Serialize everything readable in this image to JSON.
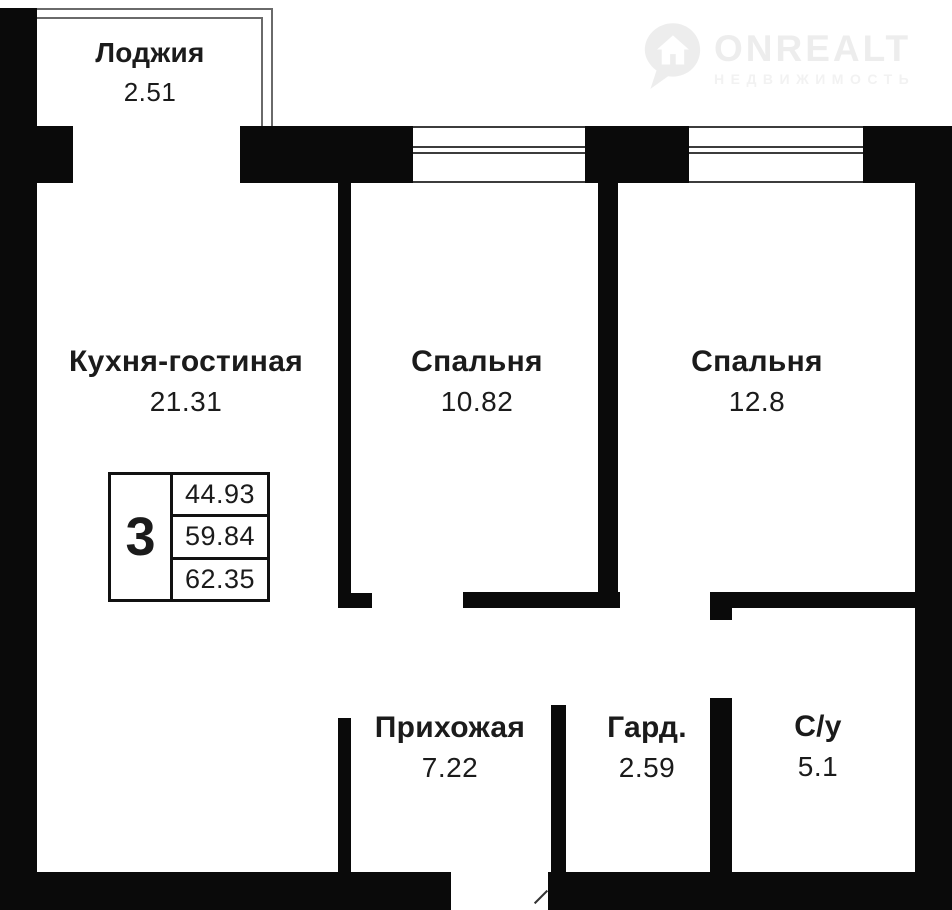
{
  "logo": {
    "brand": "ONREALT",
    "subtitle": "НЕДВИЖИМОСТЬ",
    "icon": "location-pin-with-house"
  },
  "stamp": {
    "rooms_count": "3",
    "areas": [
      "44.93",
      "59.84",
      "62.35"
    ]
  },
  "rooms": {
    "loggia": {
      "name": "Лоджия",
      "area": "2.51"
    },
    "kitchen_living": {
      "name": "Кухня-гостиная",
      "area": "21.31"
    },
    "bedroom1": {
      "name": "Спальня",
      "area": "10.82"
    },
    "bedroom2": {
      "name": "Спальня",
      "area": "12.8"
    },
    "hallway": {
      "name": "Прихожая",
      "area": "7.22"
    },
    "wardrobe": {
      "name": "Гард.",
      "area": "2.59"
    },
    "bathroom": {
      "name": "С/у",
      "area": "5.1"
    }
  },
  "colors": {
    "wall": "#0a0a0a",
    "text": "#1b1b1b",
    "logo_watermark": "#ededed",
    "background": "#ffffff"
  }
}
